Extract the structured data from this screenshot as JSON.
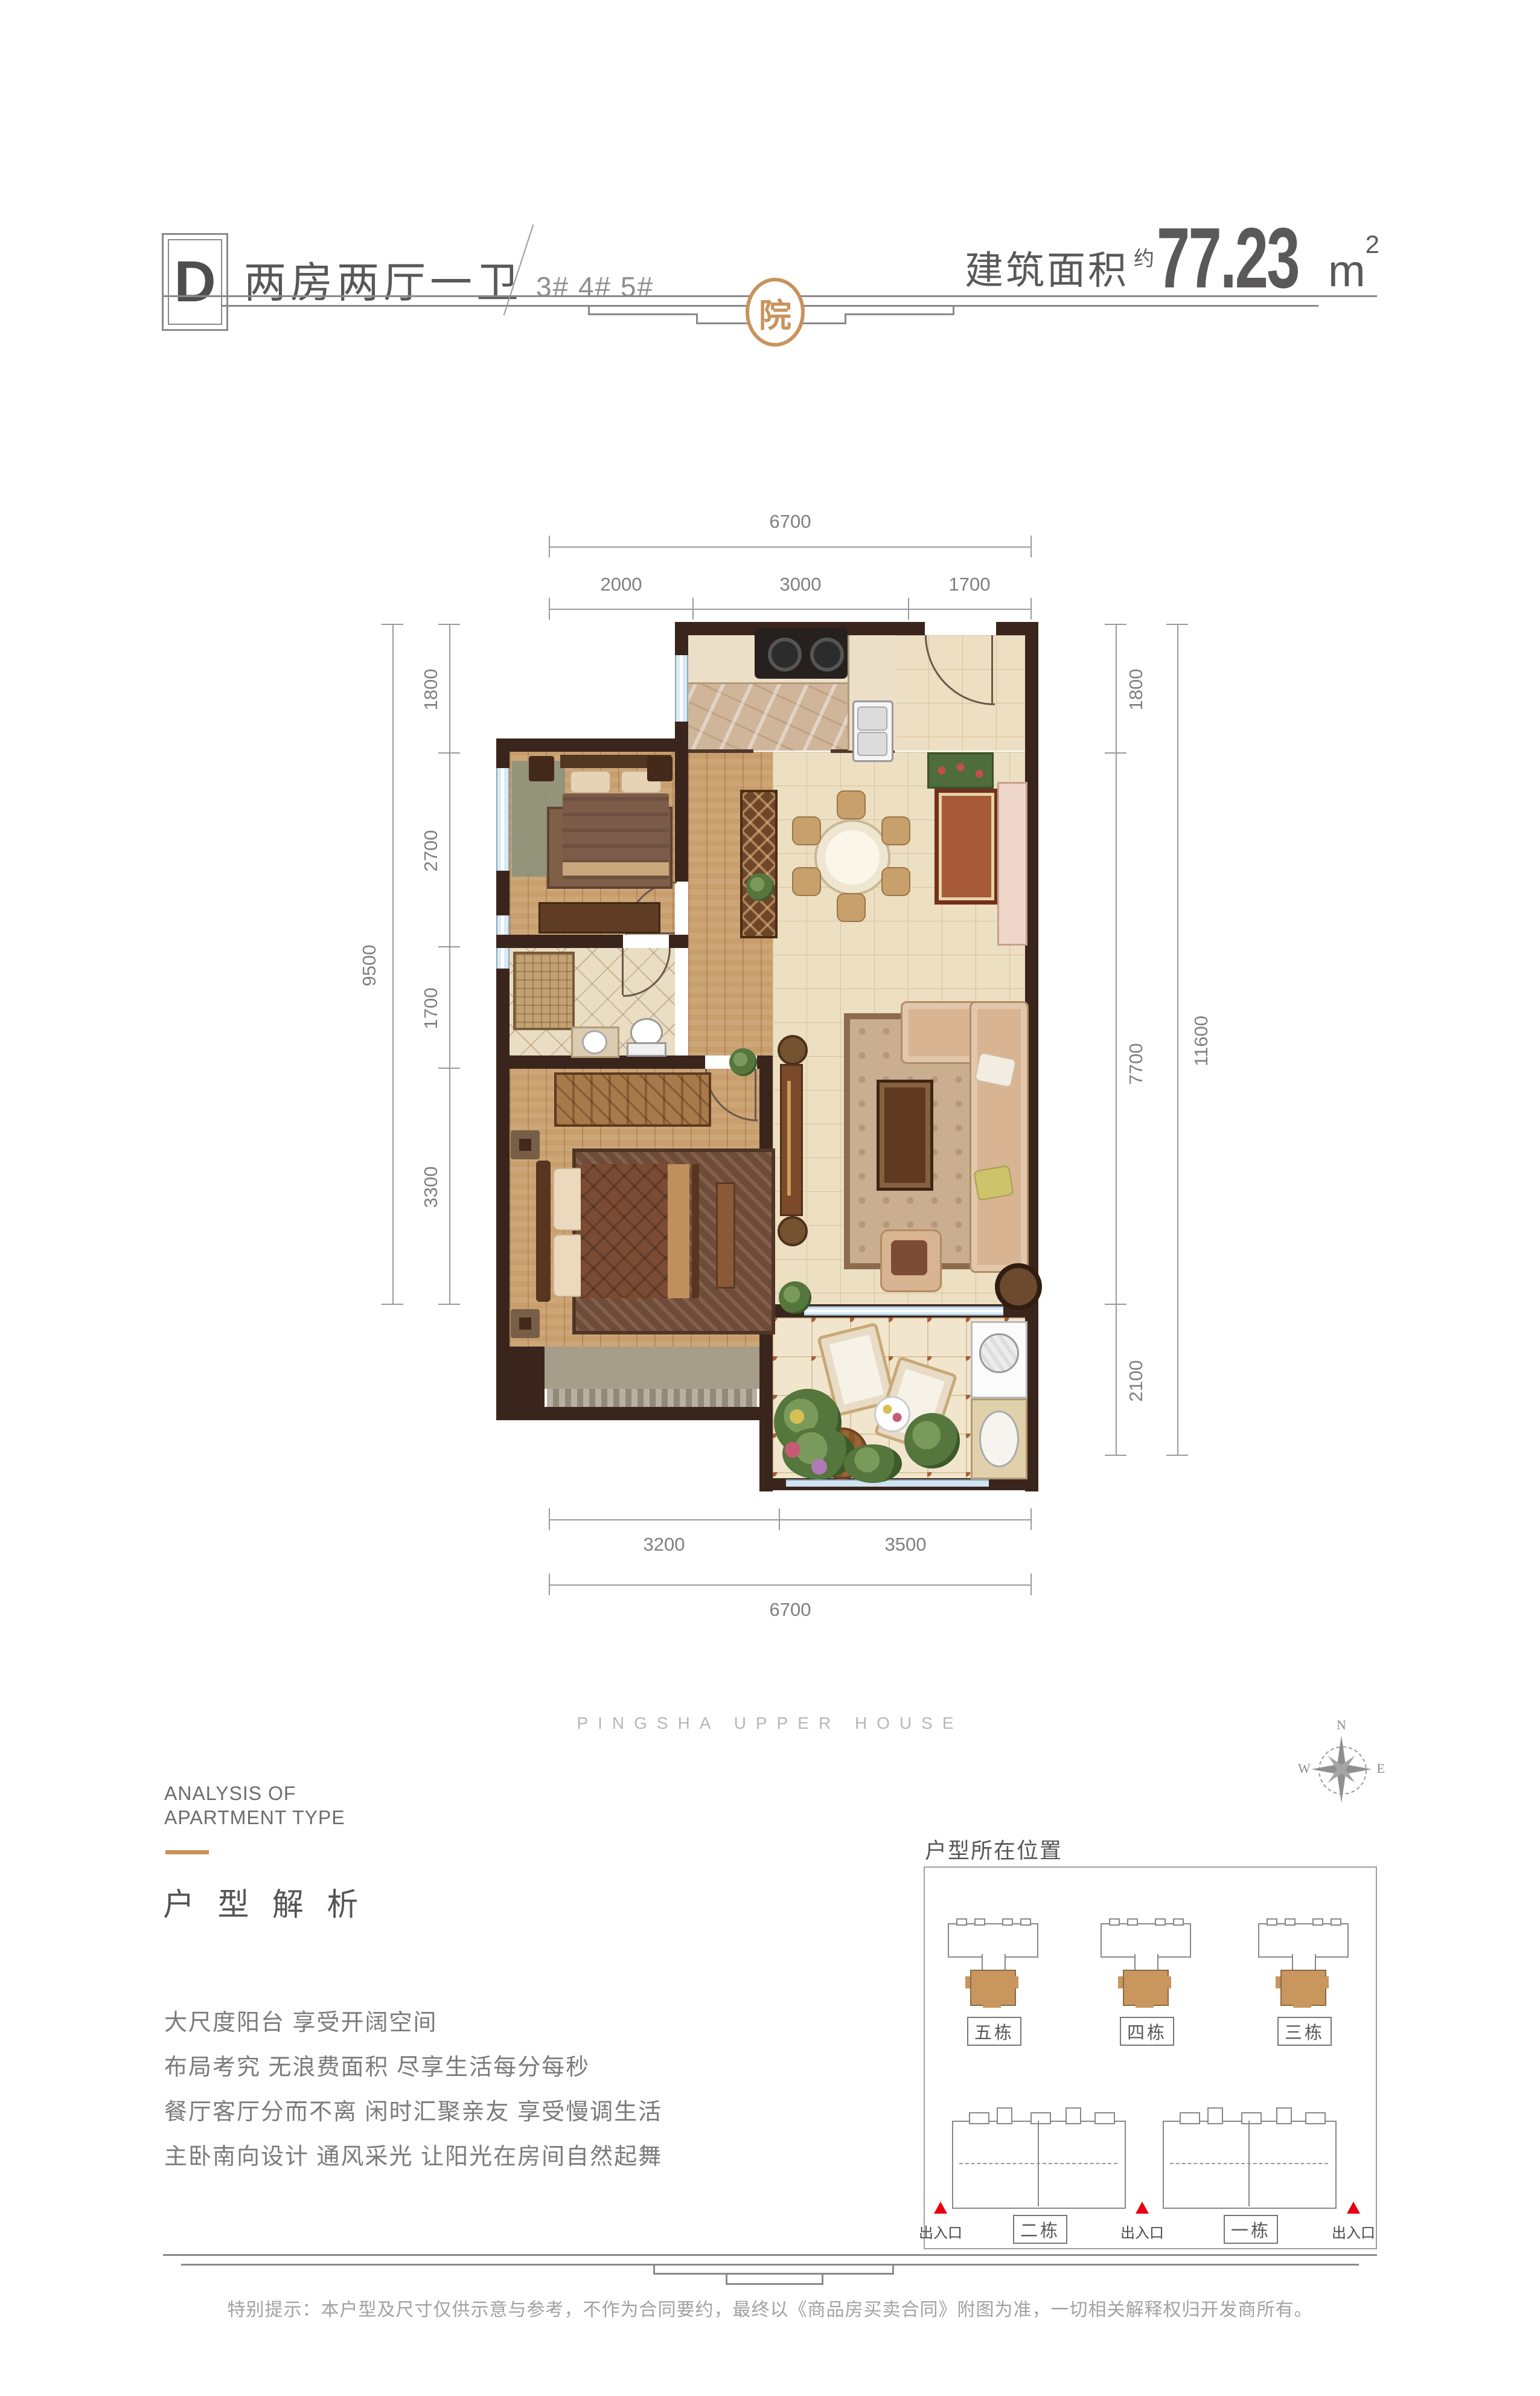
{
  "header": {
    "unit_label": "D",
    "unit_title": "两房两厅一卫",
    "unit_buildings": "3# 4# 5#",
    "area_label": "建筑面积",
    "area_approx": "约",
    "area_value": "77.23",
    "area_unit": "m",
    "area_unit_sup": "2"
  },
  "ornament": {
    "seal_char": "院",
    "accent_gold": "#c8935c"
  },
  "plan": {
    "wall_color": "#3a251d",
    "dims": {
      "top_total": "6700",
      "top_segments": [
        "2000",
        "3000",
        "1700"
      ],
      "left_total": "9500",
      "left_segments": [
        "1800",
        "2700",
        "1700",
        "3300"
      ],
      "right_total": "11600",
      "right_segments": [
        "1800",
        "7700",
        "2100"
      ],
      "bottom_total": "6700",
      "bottom_segments": [
        "3200",
        "3500"
      ]
    }
  },
  "watermark": "PINGSHA UPPER HOUSE",
  "analysis": {
    "en_line1": "ANALYSIS OF",
    "en_line2": "APARTMENT TYPE",
    "cn_title": "户 型 解 析",
    "features": [
      "大尺度阳台 享受开阔空间",
      "布局考究 无浪费面积 尽享生活每分每秒",
      "餐厅客厅分而不离 闲时汇聚亲友 享受慢调生活",
      "主卧南向设计 通风采光 让阳光在房间自然起舞"
    ]
  },
  "location": {
    "title": "户型所在位置",
    "top_buildings": [
      "五栋",
      "四栋",
      "三栋"
    ],
    "bottom_buildings": [
      "二栋",
      "一栋"
    ],
    "entrance_label": "出入口",
    "highlight_color": "#c9965e",
    "entrance_color": "#e60012"
  },
  "compass": {
    "n": "N",
    "w": "W",
    "e": "E"
  },
  "disclaimer": "特别提示：本户型及尺寸仅供示意与参考，不作为合同要约，最终以《商品房买卖合同》附图为准，一切相关解释权归开发商所有。"
}
